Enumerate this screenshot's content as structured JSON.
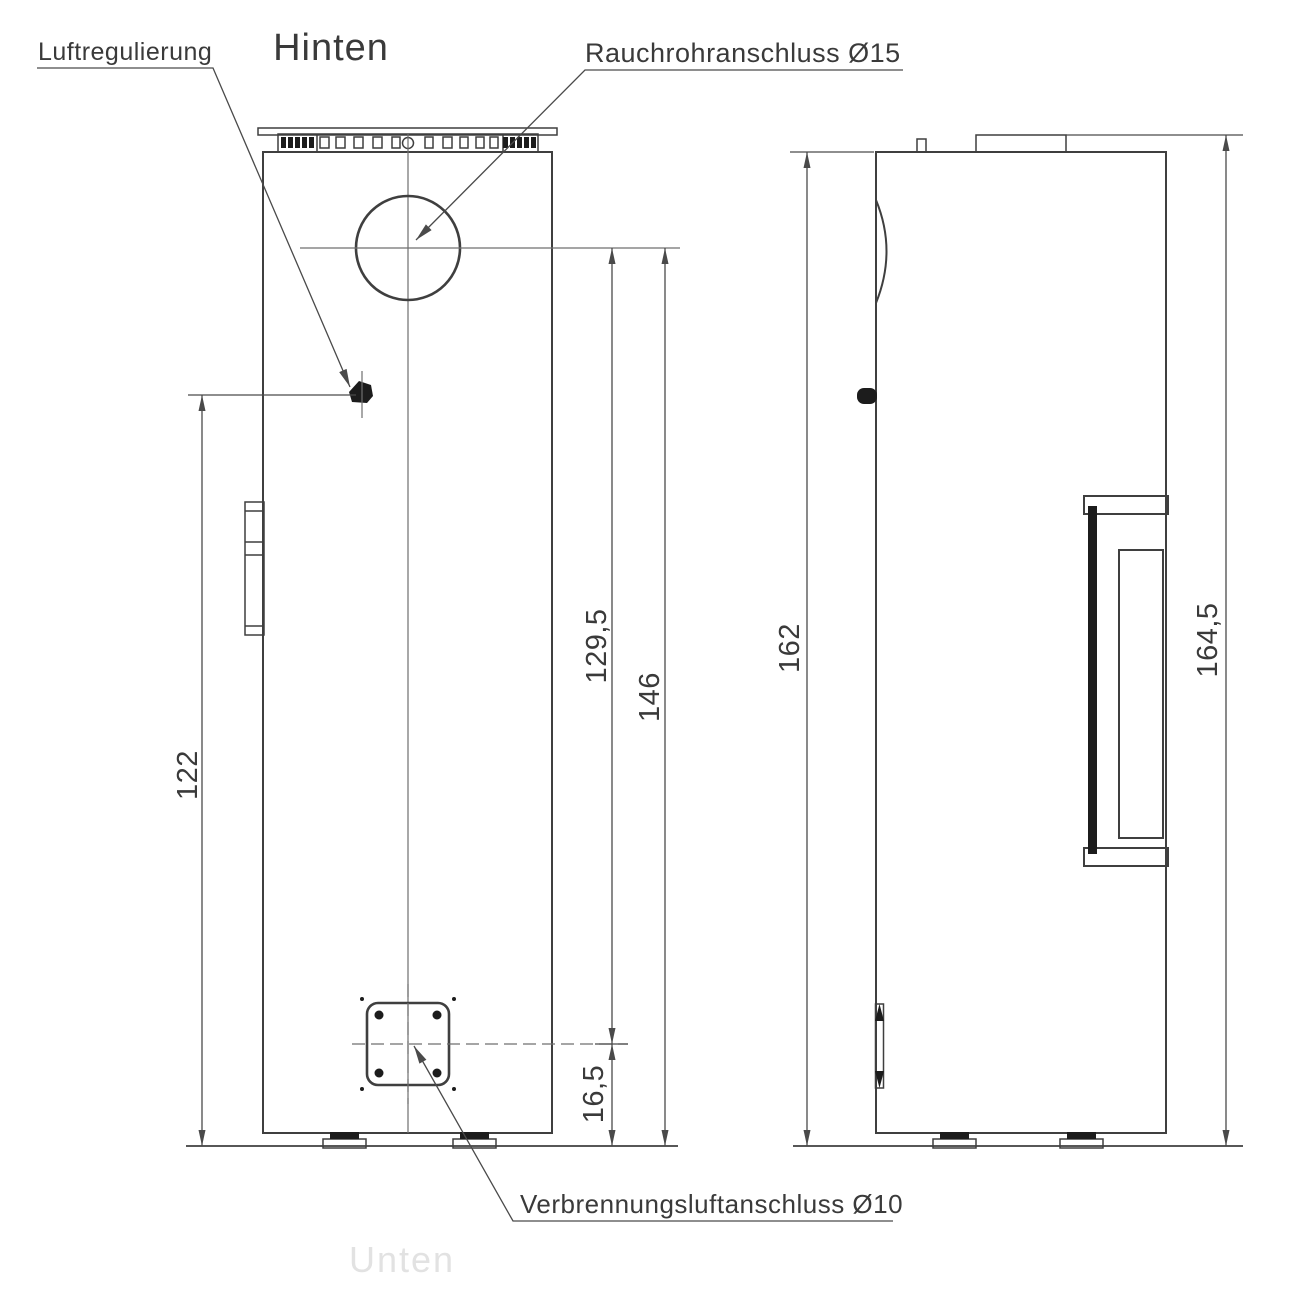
{
  "title": "Hinten",
  "faint_label": "Unten",
  "labels": {
    "air_regulation": "Luftregulierung",
    "flue_connection": "Rauchrohranschluss Ø15",
    "combustion_air": "Verbrennungsluftanschluss Ø10"
  },
  "dimensions": {
    "knob_height_cm": "122",
    "flue_center_to_air_center_cm": "129,5",
    "flue_center_to_floor_cm": "146",
    "air_center_to_floor_cm": "16,5",
    "body_height_cm": "162",
    "total_height_cm": "164,5"
  },
  "colors": {
    "outline": "#3f3f3f",
    "dimension": "#4a4a4a",
    "text": "#3a3a3a",
    "faint": "#e2e2e2"
  },
  "vent_slots": [
    {
      "x": 281,
      "w": 5,
      "filled": true
    },
    {
      "x": 288,
      "w": 5,
      "filled": true
    },
    {
      "x": 295,
      "w": 5,
      "filled": true
    },
    {
      "x": 302,
      "w": 5,
      "filled": true
    },
    {
      "x": 309,
      "w": 5,
      "filled": true
    },
    {
      "x": 320,
      "w": 9,
      "filled": false
    },
    {
      "x": 336,
      "w": 9,
      "filled": false
    },
    {
      "x": 354,
      "w": 9,
      "filled": false
    },
    {
      "x": 373,
      "w": 9,
      "filled": false
    },
    {
      "x": 392,
      "w": 8,
      "filled": false
    },
    {
      "x": 425,
      "w": 8,
      "filled": false
    },
    {
      "x": 443,
      "w": 9,
      "filled": false
    },
    {
      "x": 460,
      "w": 8,
      "filled": false
    },
    {
      "x": 476,
      "w": 8,
      "filled": false
    },
    {
      "x": 490,
      "w": 8,
      "filled": false
    },
    {
      "x": 503,
      "w": 5,
      "filled": true
    },
    {
      "x": 510,
      "w": 5,
      "filled": true
    },
    {
      "x": 517,
      "w": 5,
      "filled": true
    },
    {
      "x": 524,
      "w": 5,
      "filled": true
    },
    {
      "x": 531,
      "w": 5,
      "filled": true
    }
  ]
}
